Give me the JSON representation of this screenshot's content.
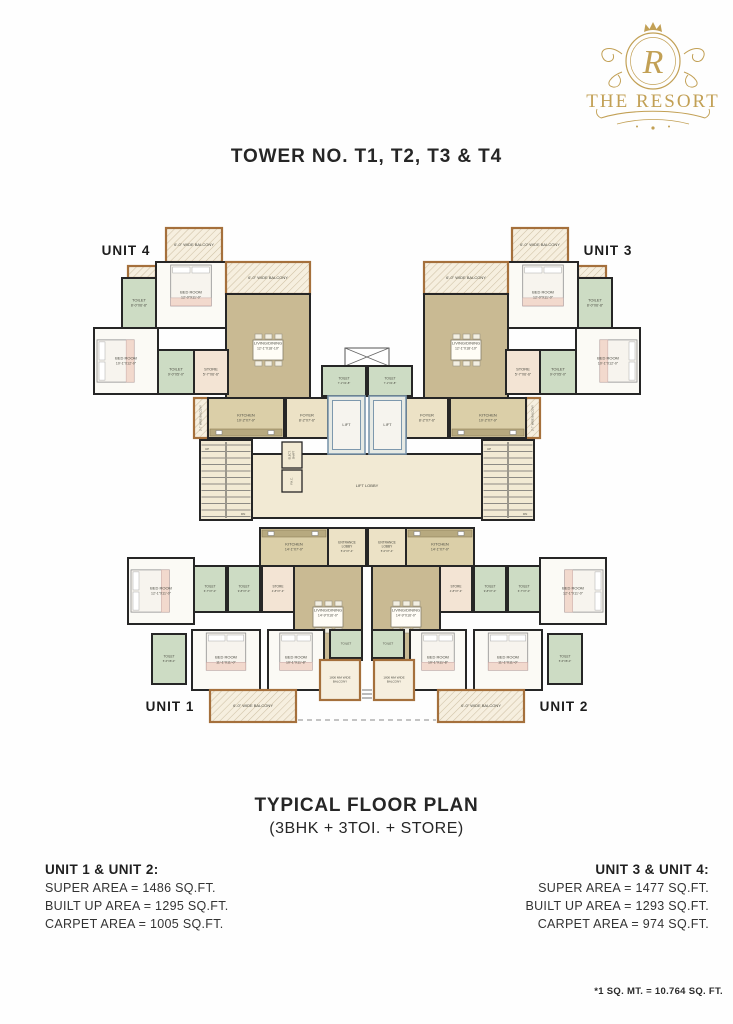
{
  "logo": {
    "name": "THE RESORT",
    "monogram": "R",
    "color": "#c2a055"
  },
  "title": "TOWER NO. T1, T2, T3 & T4",
  "caption": {
    "line1": "TYPICAL FLOOR PLAN",
    "line2": "(3BHK + 3TOI. + STORE)"
  },
  "areas_left": {
    "heading": "UNIT 1 & UNIT 2:",
    "lines": [
      "SUPER AREA = 1486 SQ.FT.",
      "BUILT UP AREA =  1295 SQ.FT.",
      "CARPET AREA = 1005 SQ.FT."
    ]
  },
  "areas_right": {
    "heading": "UNIT 3 & UNIT 4:",
    "lines": [
      "SUPER AREA = 1477 SQ.FT.",
      "BUILT UP AREA = 1293 SQ.FT.",
      "CARPET AREA = 974 SQ.FT."
    ]
  },
  "footnote": "*1 SQ. MT. = 10.764 SQ. FT.",
  "plan": {
    "colors": {
      "wall": "#262626",
      "bedroom": "#fbfaf5",
      "toilet": "#cddcc4",
      "store": "#f3e4d4",
      "living": "#c9ba93",
      "kitchen": "#dbcfa8",
      "foyer": "#ece2c6",
      "lobby": "#f2ead4",
      "lift_fill": "#e7eae4",
      "lift_wall": "#7d98ad",
      "balcony_wall": "#a5703c",
      "balcony_fill": "#f6efdf",
      "label": "#4b4b42",
      "unit_label": "#1d1d1d"
    },
    "unit_labels": [
      {
        "text": "UNIT 4",
        "x": 44,
        "y": 33
      },
      {
        "text": "UNIT 3",
        "x": 526,
        "y": 33
      },
      {
        "text": "UNIT 1",
        "x": 88,
        "y": 489
      },
      {
        "text": "UNIT 2",
        "x": 482,
        "y": 489
      }
    ],
    "rooms_left": [
      {
        "t": "balcony",
        "n": "6'-0\" WIDE BALCONY",
        "x": 84,
        "y": 6,
        "w": 56,
        "h": 34
      },
      {
        "t": "balcony",
        "n": "",
        "x": 46,
        "y": 44,
        "w": 28,
        "h": 12
      },
      {
        "t": "bedroom",
        "n": "BED ROOM",
        "d": "12'-0\"X11'-0\"",
        "x": 74,
        "y": 40,
        "w": 70,
        "h": 66,
        "f": "bed-n"
      },
      {
        "t": "toilet",
        "n": "TOILET",
        "d": "8'-0\"X6'-8\"",
        "x": 40,
        "y": 56,
        "w": 34,
        "h": 50
      },
      {
        "t": "balcony",
        "n": "6'-0\" WIDE BALCONY",
        "x": 144,
        "y": 40,
        "w": 84,
        "h": 32
      },
      {
        "t": "living",
        "n": "LIVING/DINING",
        "d": "12'-1\"X18'-10\"",
        "x": 144,
        "y": 72,
        "w": 84,
        "h": 104,
        "f": "table6"
      },
      {
        "t": "bedroom",
        "n": "BED ROOM",
        "d": "10'-1\"X12'-0\"",
        "x": 12,
        "y": 106,
        "w": 64,
        "h": 66,
        "f": "bed-w"
      },
      {
        "t": "toilet",
        "n": "TOILET",
        "d": "9'-0\"X5'-0\"",
        "x": 76,
        "y": 128,
        "w": 36,
        "h": 44
      },
      {
        "t": "store",
        "n": "STORE",
        "d": "5'-7\"X6'-6\"",
        "x": 112,
        "y": 128,
        "w": 34,
        "h": 44
      },
      {
        "t": "balcony",
        "n": "2'-7\" WIDE BALCONY",
        "x": 112,
        "y": 176,
        "w": 14,
        "h": 40,
        "v": true,
        "fs": 2.6
      },
      {
        "t": "kitchen",
        "n": "KITCHEN",
        "d": "10'-2\"X7'-9\"",
        "x": 126,
        "y": 176,
        "w": 76,
        "h": 40,
        "f": "counter-s"
      },
      {
        "t": "foyer",
        "n": "FOYER",
        "d": "8'-2\"X7'-6\"",
        "x": 204,
        "y": 176,
        "w": 42,
        "h": 40
      },
      {
        "t": "kitchen",
        "n": "KITCHEN",
        "d": "14'-1\"X7'-0\"",
        "x": 178,
        "y": 306,
        "w": 68,
        "h": 38,
        "f": "counter-n"
      },
      {
        "t": "foyer",
        "n": "ENTRANCE\nLOBBY",
        "d": "5'-0\"X7'-4\"",
        "x": 246,
        "y": 306,
        "w": 38,
        "h": 38,
        "fs": 3.2
      },
      {
        "t": "living",
        "n": "LIVING/DINING",
        "d": "14'-9\"X16'-0\"",
        "x": 212,
        "y": 344,
        "w": 68,
        "h": 94,
        "f": "table6"
      },
      {
        "t": "toilet",
        "n": "TOILET",
        "d": "6'-7\"X7'-0\"",
        "x": 112,
        "y": 344,
        "w": 32,
        "h": 46,
        "fs": 3.2
      },
      {
        "t": "toilet",
        "n": "TOILET",
        "d": "9'-8\"X7'-0\"",
        "x": 146,
        "y": 344,
        "w": 32,
        "h": 46,
        "fs": 3.2
      },
      {
        "t": "store",
        "n": "STORE",
        "d": "4'-8\"X7'-3\"",
        "x": 180,
        "y": 344,
        "w": 32,
        "h": 46,
        "fs": 3.2
      },
      {
        "t": "bedroom",
        "n": "BED ROOM",
        "d": "12'-1\"X11'-0\"",
        "x": 46,
        "y": 336,
        "w": 66,
        "h": 66,
        "f": "bed-w"
      },
      {
        "t": "toilet",
        "n": "TOILET",
        "d": "5'-6\"X8'-0\"",
        "x": 70,
        "y": 412,
        "w": 34,
        "h": 50,
        "fs": 3.2
      },
      {
        "t": "bedroom",
        "n": "BED ROOM",
        "d": "11'-1\"X11'-0\"",
        "x": 110,
        "y": 408,
        "w": 68,
        "h": 60,
        "f": "bed-n"
      },
      {
        "t": "bedroom",
        "n": "BED ROOM",
        "d": "10'-1\"X11'-8\"",
        "x": 186,
        "y": 408,
        "w": 56,
        "h": 60,
        "f": "bed-n"
      },
      {
        "t": "toilet",
        "n": "TOILET",
        "d": "",
        "x": 248,
        "y": 408,
        "w": 32,
        "h": 28,
        "fs": 3
      },
      {
        "t": "balcony2",
        "n": "1800 MM WIDE\nBALCONY",
        "x": 238,
        "y": 438,
        "w": 40,
        "h": 40,
        "fs": 3
      },
      {
        "t": "balcony",
        "n": "6'-0\" WIDE BALCONY",
        "x": 128,
        "y": 468,
        "w": 86,
        "h": 32
      }
    ],
    "rooms_center": [
      {
        "t": "lobby",
        "n": "LIFT LOBBY",
        "x": 170,
        "y": 232,
        "w": 230,
        "h": 64
      },
      {
        "t": "stair",
        "x": 118,
        "y": 218,
        "w": 52,
        "h": 80
      },
      {
        "t": "stair",
        "x": 400,
        "y": 218,
        "w": 52,
        "h": 80
      },
      {
        "t": "shaft",
        "n": "ELECT.\nSHAFT",
        "x": 200,
        "y": 220,
        "w": 20,
        "h": 26,
        "fs": 2.6,
        "v": true
      },
      {
        "t": "shaft",
        "n": "F.H.C.",
        "x": 200,
        "y": 248,
        "w": 20,
        "h": 22,
        "fs": 2.6,
        "v": true
      },
      {
        "t": "duct",
        "x": 263,
        "y": 126,
        "w": 44,
        "h": 18
      },
      {
        "t": "toilet",
        "n": "TOILET",
        "d": "7'-1\"X4'-8\"",
        "x": 240,
        "y": 144,
        "w": 44,
        "h": 30,
        "fs": 3.2
      },
      {
        "t": "toilet",
        "n": "TOILET",
        "d": "7'-1\"X4'-8\"",
        "x": 286,
        "y": 144,
        "w": 44,
        "h": 30,
        "fs": 3.2
      },
      {
        "t": "lift",
        "n": "LIFT",
        "x": 246,
        "y": 174,
        "w": 37,
        "h": 58
      },
      {
        "t": "lift",
        "n": "LIFT",
        "x": 287,
        "y": 174,
        "w": 37,
        "h": 58
      }
    ],
    "stair_text": {
      "up": "UP",
      "dn": "DN"
    }
  }
}
